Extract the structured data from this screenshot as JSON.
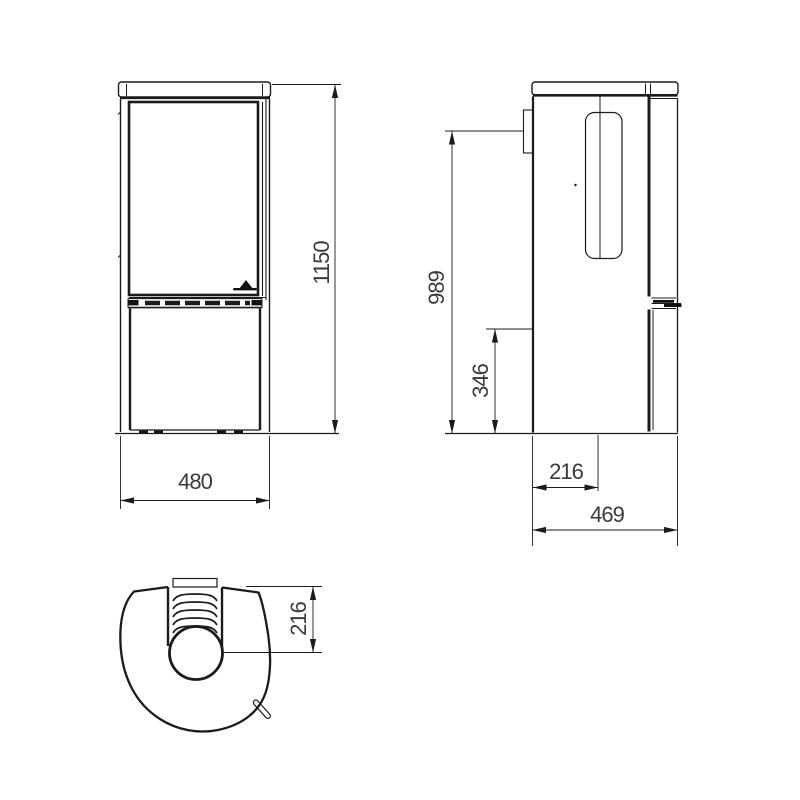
{
  "colors": {
    "background": "#ffffff",
    "line": "#1b1b1b",
    "text": "#3a3a3a"
  },
  "dimensions": {
    "front_height": "1150",
    "front_width": "480",
    "side_flue_height": "989",
    "side_mid_height": "346",
    "side_flue_offset": "216",
    "side_depth": "469",
    "top_flue_offset": "216"
  }
}
